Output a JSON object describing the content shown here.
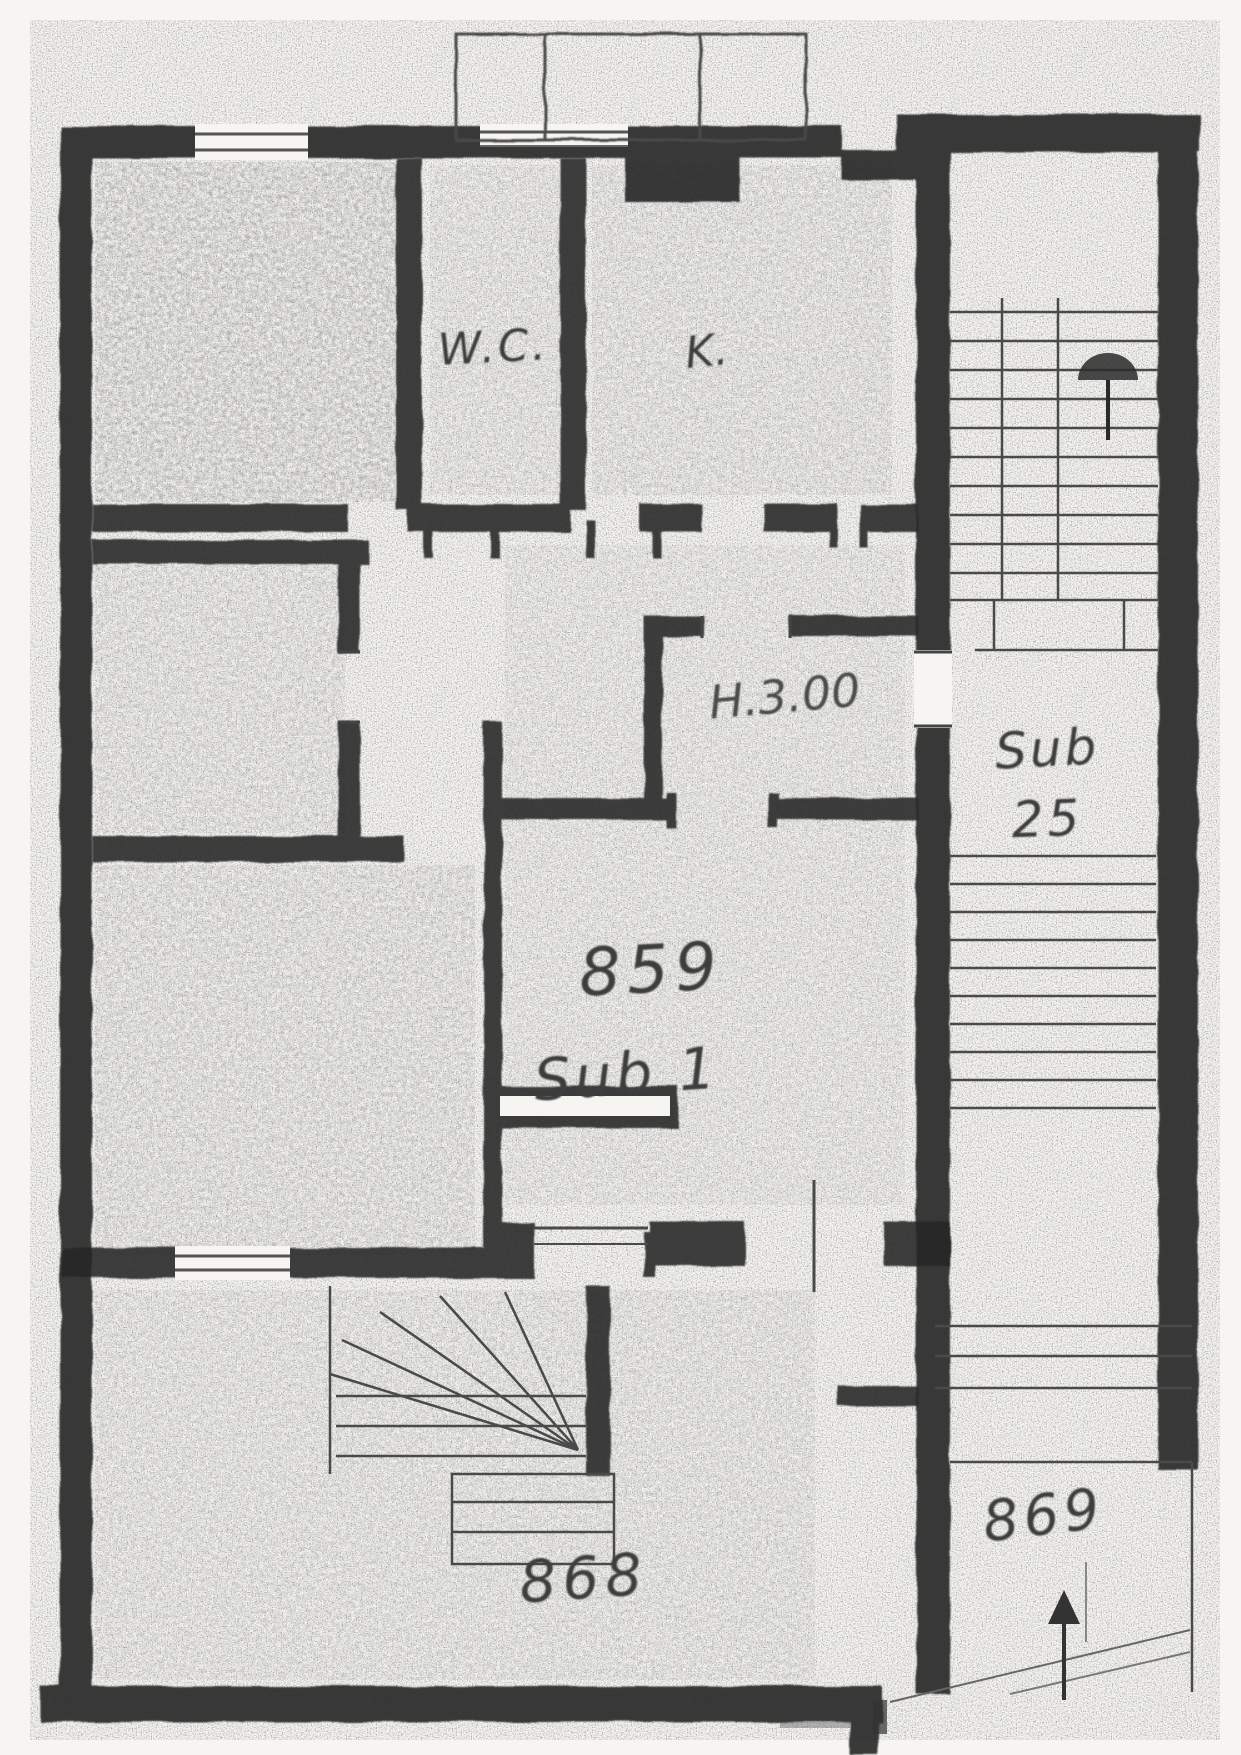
{
  "labels": {
    "wc": "W.C.",
    "kitchen": "K.",
    "height_note": "H.3.00",
    "parcel_main_number": "859",
    "parcel_main_sub": "Sub 1",
    "parcel_stair_line1": "Sub",
    "parcel_stair_line2": "25",
    "parcel_bottom": "868",
    "parcel_right": "869"
  },
  "colors": {
    "paper": "#f6f5f2",
    "wall_ink": "#262626",
    "pencil": "#3c3c3c"
  }
}
